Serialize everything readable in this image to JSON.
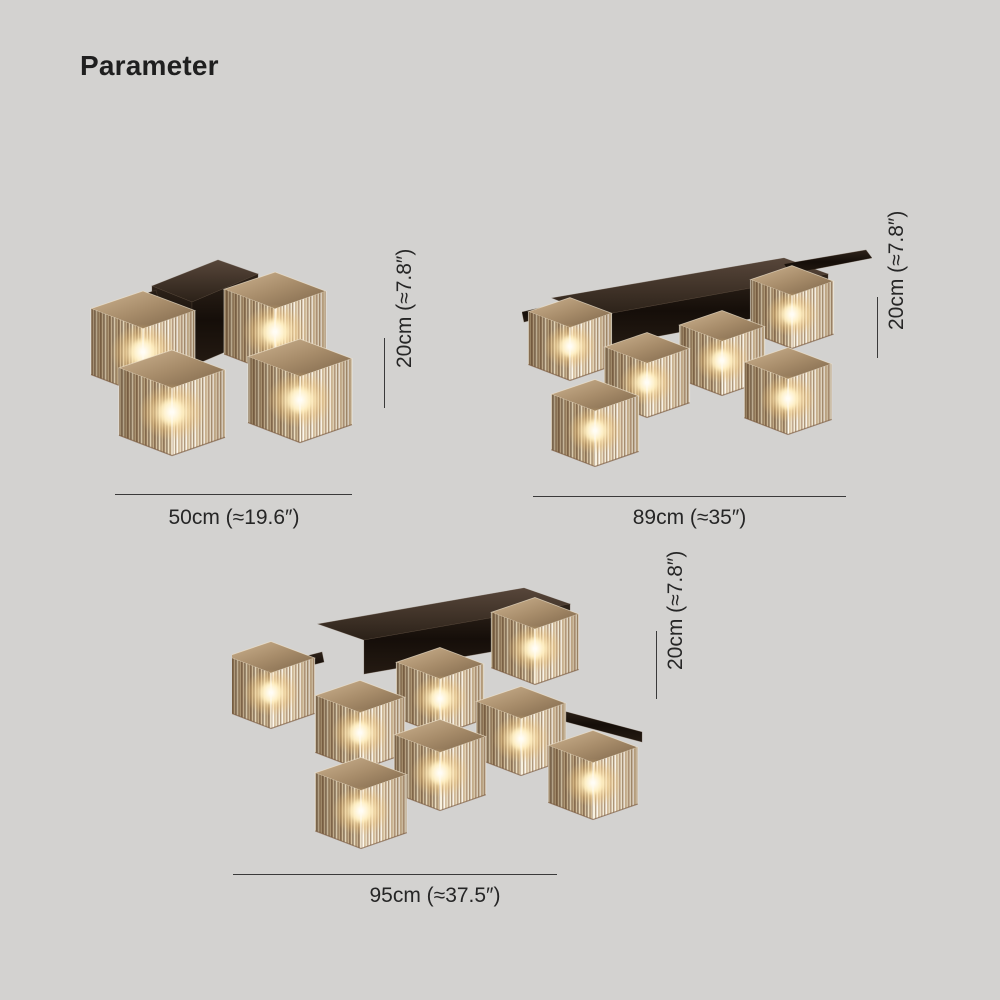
{
  "page": {
    "title": "Parameter",
    "background_color": "#d3d2d0",
    "text_color": "#262626",
    "dimension_line_color": "#3a3a3a"
  },
  "fixtures": [
    {
      "image": "crystal-cube-ceiling-light-4-heads",
      "lights": 4,
      "width_label": "50cm (≈19.6″)",
      "height_label": "20cm (≈7.8″)"
    },
    {
      "image": "crystal-cube-ceiling-light-6-heads",
      "lights": 6,
      "width_label": "89cm (≈35″)",
      "height_label": "20cm (≈7.8″)"
    },
    {
      "image": "crystal-cube-ceiling-light-8-heads",
      "lights": 8,
      "width_label": "95cm (≈37.5″)",
      "height_label": "20cm (≈7.8″)"
    }
  ],
  "colors": {
    "crystal_light": "#f8f1de",
    "crystal_mid": "#dfcca9",
    "crystal_dark": "#8d7254",
    "frame_dark": "#150e09",
    "bulb_glow": "#ffedbe"
  }
}
